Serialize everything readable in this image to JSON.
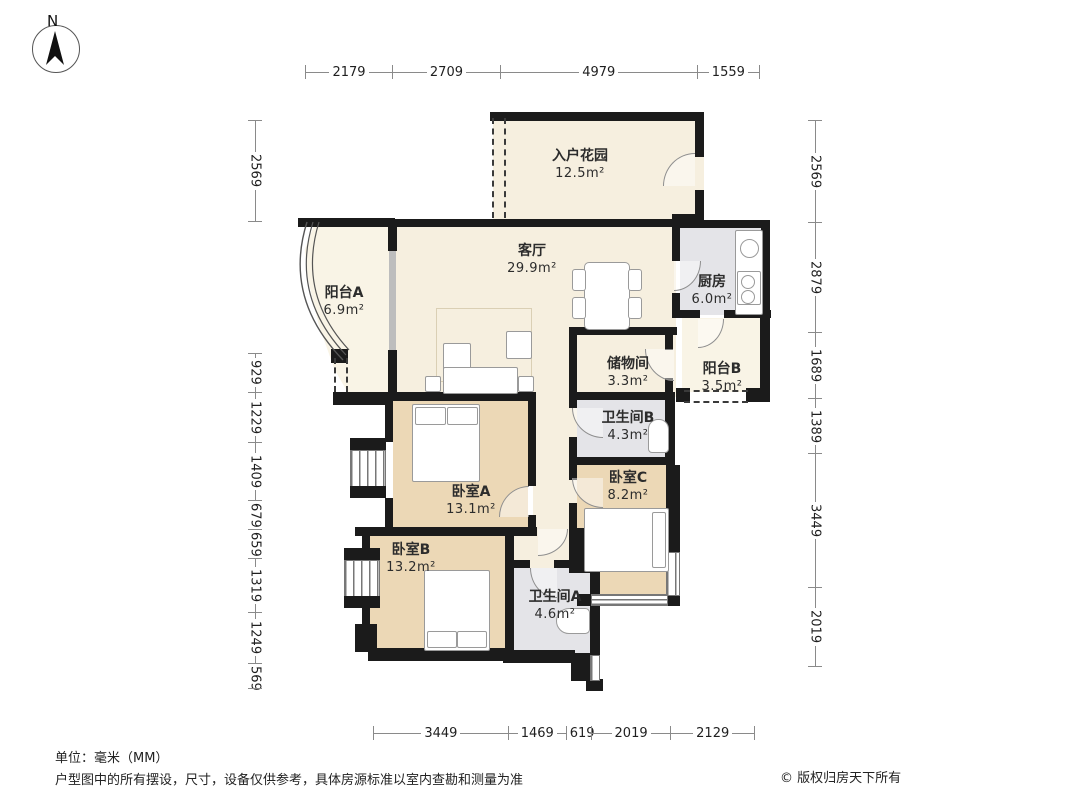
{
  "compass": {
    "label": "N"
  },
  "dimensions": {
    "top": [
      "2179",
      "2709",
      "4979",
      "1559"
    ],
    "left_upper": [
      "2569"
    ],
    "left_lower": [
      "929",
      "1229",
      "1409",
      "679",
      "659",
      "1319",
      "1249",
      "569"
    ],
    "right": [
      "2569",
      "2879",
      "1689",
      "1389",
      "3449",
      "2019"
    ],
    "bottom": [
      "3449",
      "1469",
      "619",
      "2019",
      "2129"
    ]
  },
  "rooms": {
    "entry_garden": {
      "name": "入户花园",
      "area": "12.5m²"
    },
    "living": {
      "name": "客厅",
      "area": "29.9m²"
    },
    "kitchen": {
      "name": "厨房",
      "area": "6.0m²"
    },
    "balcony_a": {
      "name": "阳台A",
      "area": "6.9m²"
    },
    "storage": {
      "name": "储物间",
      "area": "3.3m²"
    },
    "balcony_b": {
      "name": "阳台B",
      "area": "3.5m²"
    },
    "bath_b": {
      "name": "卫生间B",
      "area": "4.3m²"
    },
    "bed_a": {
      "name": "卧室A",
      "area": "13.1m²"
    },
    "bed_c": {
      "name": "卧室C",
      "area": "8.2m²"
    },
    "bed_b": {
      "name": "卧室B",
      "area": "13.2m²"
    },
    "bath_a": {
      "name": "卫生间A",
      "area": "4.6m²"
    }
  },
  "footer": {
    "unit": "单位：毫米（MM）",
    "disclaimer": "户型图中的所有摆设，尺寸，设备仅供参考，具体房源标准以室内查勘和测量为准",
    "copyright": "© 版权归房天下所有"
  },
  "colors": {
    "wall": "#1b1b1b",
    "floor_cream": "#f6efdf",
    "floor_tan": "#ecd8b6",
    "floor_gray": "#e4e4e8",
    "floor_balcony": "#f9f4e6",
    "line_gray": "#8a8a8a",
    "text_dark": "#2c2c2c"
  }
}
